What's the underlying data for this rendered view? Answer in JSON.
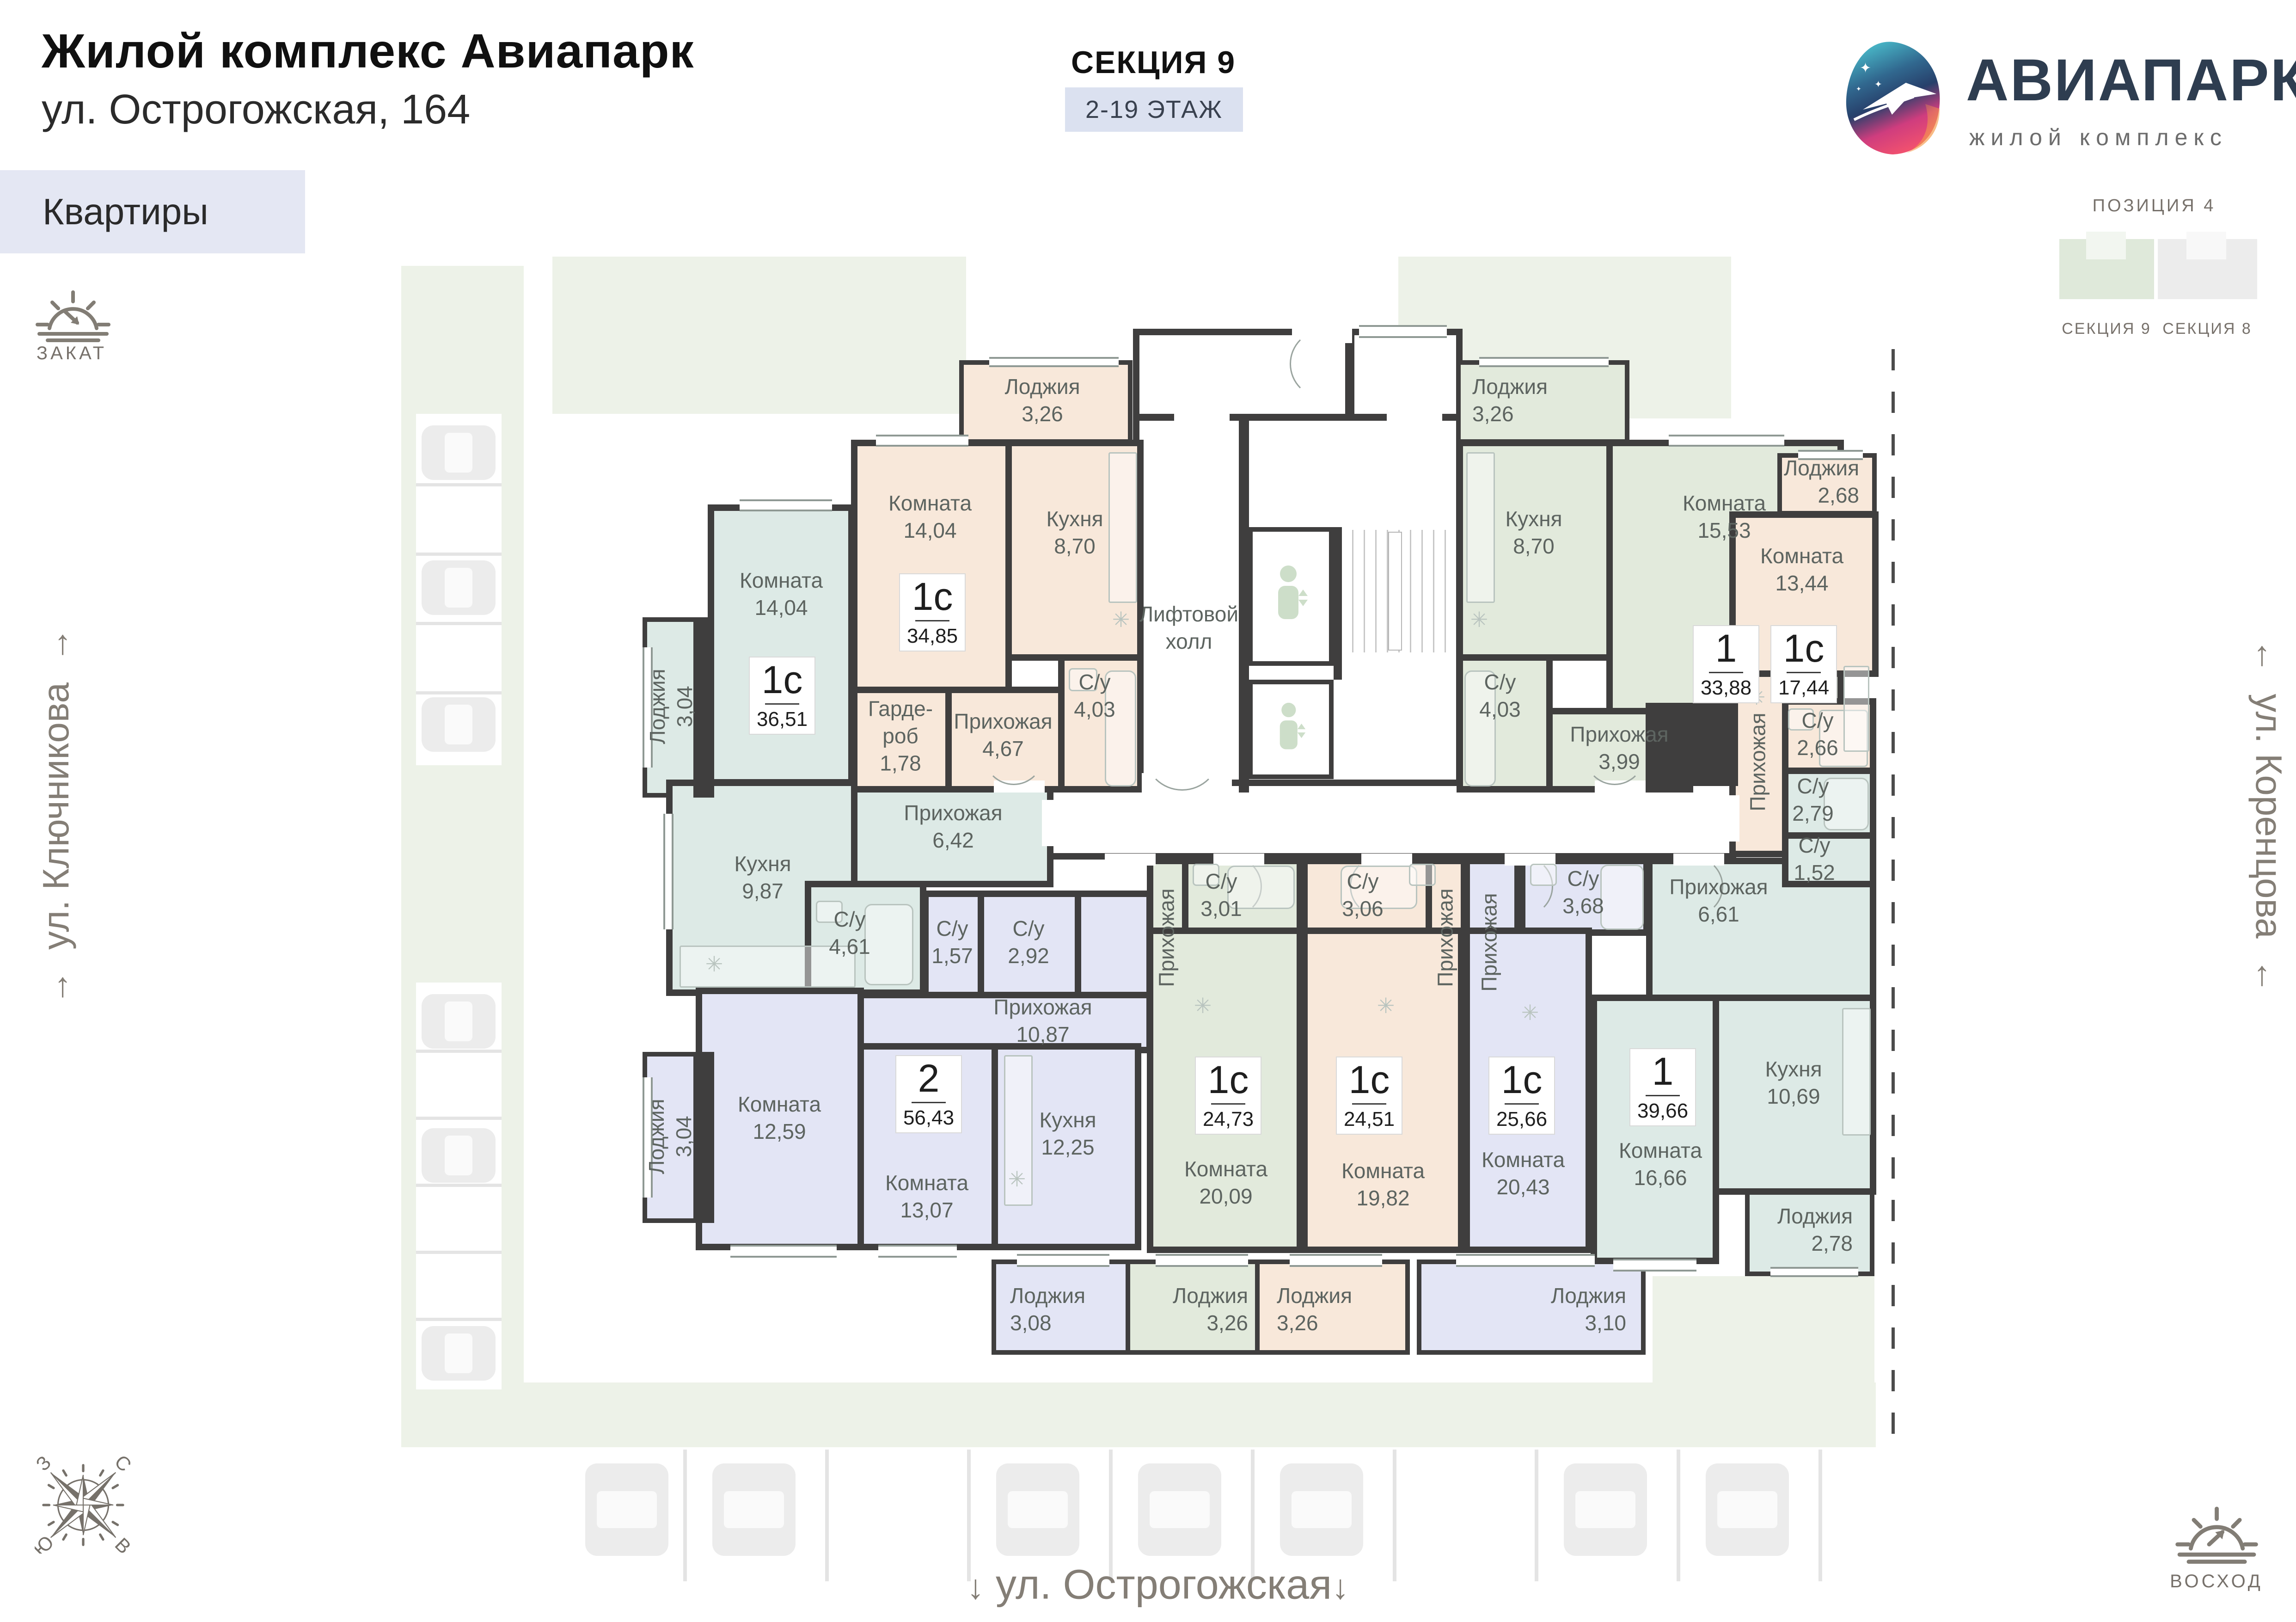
{
  "header": {
    "title": "Жилой комплекс Авиапарк",
    "address": "ул. Острогожская, 164",
    "apartments_label": "Квартиры",
    "section_title": "СЕКЦИЯ 9",
    "floors_badge": "2-19 ЭТАЖ"
  },
  "logo": {
    "name": "АВИАПАРК",
    "subtitle": "жилой комплекс"
  },
  "position_map": {
    "title": "ПОЗИЦИЯ 4",
    "left_label": "СЕКЦИЯ 9",
    "right_label": "СЕКЦИЯ 8"
  },
  "orientation": {
    "sunset_label": "ЗАКАТ",
    "sunrise_label": "ВОСХОД",
    "compass": {
      "north": "С",
      "east": "В",
      "south": "Ю",
      "west": "З"
    }
  },
  "streets": {
    "left": "ул. Ключникова",
    "right": "ул. Коренцова",
    "bottom": "ул. Острогожская"
  },
  "core": {
    "lift_hall_l1": "Лифтовой",
    "lift_hall_l2": "холл"
  },
  "apartments": [
    {
      "type": "1с",
      "area": "36,51",
      "color": "teal",
      "rooms": {
        "komnata": {
          "label": "Комната",
          "area": "14,04"
        },
        "kuhnya": {
          "label": "Кухня",
          "area": "9,87"
        },
        "prihozhaya": {
          "label": "Прихожая",
          "area": "6,42"
        },
        "su": {
          "label": "С/у",
          "area": "4,61"
        },
        "loggia": {
          "label": "Лоджия",
          "area": "3,04"
        }
      }
    },
    {
      "type": "1с",
      "area": "34,85",
      "color": "beige",
      "rooms": {
        "komnata": {
          "label": "Комната",
          "area": "14,04"
        },
        "kuhnya": {
          "label": "Кухня",
          "area": "8,70"
        },
        "garderob": {
          "l1": "Гарде-",
          "l2": "роб",
          "area": "1,78"
        },
        "prihozhaya": {
          "label": "Прихожая",
          "area": "4,67"
        },
        "su": {
          "label": "С/у",
          "area": "4,03"
        },
        "loggia": {
          "label": "Лоджия",
          "area": "3,26"
        }
      }
    },
    {
      "type": "1",
      "area": "33,88",
      "color": "green",
      "rooms": {
        "kuhnya": {
          "label": "Кухня",
          "area": "8,70"
        },
        "komnata": {
          "label": "Комната",
          "area": "15,53"
        },
        "su": {
          "label": "С/у",
          "area": "4,03"
        },
        "prihozhaya": {
          "label": "Прихожая",
          "area": "3,99"
        },
        "loggia": {
          "label": "Лоджия",
          "area": "3,26"
        }
      }
    },
    {
      "type": "1с",
      "area": "17,44",
      "color": "beige",
      "rooms": {
        "loggia": {
          "label": "Лоджия",
          "area": "2,68"
        },
        "komnata": {
          "label": "Комната",
          "area": "13,44"
        },
        "prihozhaya": {
          "label": "Прихожая"
        },
        "su": {
          "label": "С/у",
          "area": "2,66"
        }
      }
    },
    {
      "type": "2",
      "area": "56,43",
      "color": "lavender",
      "rooms": {
        "komnata1": {
          "label": "Комната",
          "area": "12,59"
        },
        "loggia1": {
          "label": "Лоджия",
          "area": "3,04"
        },
        "su1": {
          "label": "С/у",
          "area": "1,57"
        },
        "su2": {
          "label": "С/у",
          "area": "2,92"
        },
        "prihozhaya": {
          "label": "Прихожая",
          "area": "10,87"
        },
        "komnata2": {
          "label": "Комната",
          "area": "13,07"
        },
        "kuhnya": {
          "label": "Кухня",
          "area": "12,25"
        },
        "loggia2": {
          "label": "Лоджия",
          "area": "3,08"
        }
      }
    },
    {
      "type": "1с",
      "area": "24,73",
      "color": "green",
      "rooms": {
        "prihozhaya": {
          "label": "Прихожая"
        },
        "su": {
          "label": "С/у",
          "area": "3,01"
        },
        "komnata": {
          "label": "Комната",
          "area": "20,09"
        },
        "loggia": {
          "label": "Лоджия",
          "area": "3,26"
        }
      }
    },
    {
      "type": "1с",
      "area": "24,51",
      "color": "beige",
      "rooms": {
        "su": {
          "label": "С/у",
          "area": "3,06"
        },
        "prihozhaya": {
          "label": "Прихожая"
        },
        "komnata": {
          "label": "Комната",
          "area": "19,82"
        },
        "loggia": {
          "label": "Лоджия",
          "area": "3,26"
        }
      }
    },
    {
      "type": "1с",
      "area": "25,66",
      "color": "lavender",
      "rooms": {
        "prihozhaya": {
          "label": "Прихожая"
        },
        "su": {
          "label": "С/у",
          "area": "3,68"
        },
        "komnata": {
          "label": "Комната",
          "area": "20,43"
        },
        "loggia": {
          "label": "Лоджия",
          "area": "3,10"
        }
      }
    },
    {
      "type": "1",
      "area": "39,66",
      "color": "teal",
      "rooms": {
        "prihozhaya": {
          "label": "Прихожая",
          "area": "6,61"
        },
        "su1": {
          "label": "С/у",
          "area": "2,79"
        },
        "su2": {
          "label": "С/у",
          "area": "1,52"
        },
        "komnata": {
          "label": "Комната",
          "area": "16,66"
        },
        "kuhnya": {
          "label": "Кухня",
          "area": "10,69"
        },
        "loggia": {
          "label": "Лоджия",
          "area": "2,78"
        }
      }
    }
  ],
  "colors": {
    "wall": "#3f3e3e",
    "teal": "#ddeae6",
    "beige": "#f8e8da",
    "green": "#e2eadc",
    "lavender": "#e3e5f5",
    "landscape": "#edf2e8",
    "badge_bg": "#dbe1f0",
    "label_gray": "#5d6460",
    "icon_gray": "#827d75",
    "logo_navy": "#2e3d50"
  }
}
